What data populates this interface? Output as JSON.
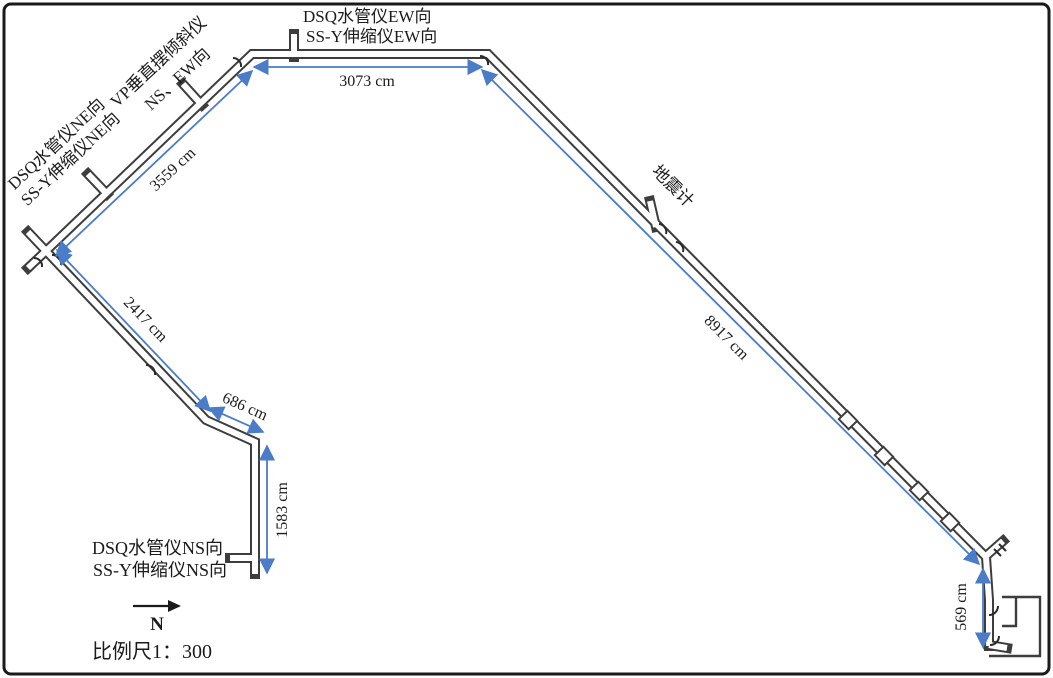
{
  "figure": {
    "instrument_labels": {
      "ew_line1": "DSQ水管仪EW向",
      "ew_line2": "SS-Y伸缩仪EW向",
      "ne_line1": "DSQ水管仪NE向",
      "ne_line2": "SS-Y伸缩仪NE向",
      "vp_line1": "VP垂直摆倾斜仪",
      "vp_line2": "NS、EW向",
      "seismometer": "地震计",
      "ns_line1": "DSQ水管仪NS向",
      "ns_line2": "SS-Y伸缩仪NS向"
    },
    "dimensions": {
      "ne_gallery": "3559 cm",
      "ew_gallery": "3073 cm",
      "se_gallery": "8917 cm",
      "sw_gallery": "2417 cm",
      "elbow_segment": "686 cm",
      "ns_gallery": "1583 cm",
      "entrance_segment": "569 cm"
    },
    "north_label": "N",
    "scale_label": "比例尺1：300",
    "colors": {
      "wall": "#3d3d3d",
      "dimension_line": "#4a7cc8",
      "text": "#1b1b1b",
      "border": "#1a1a1a"
    }
  }
}
